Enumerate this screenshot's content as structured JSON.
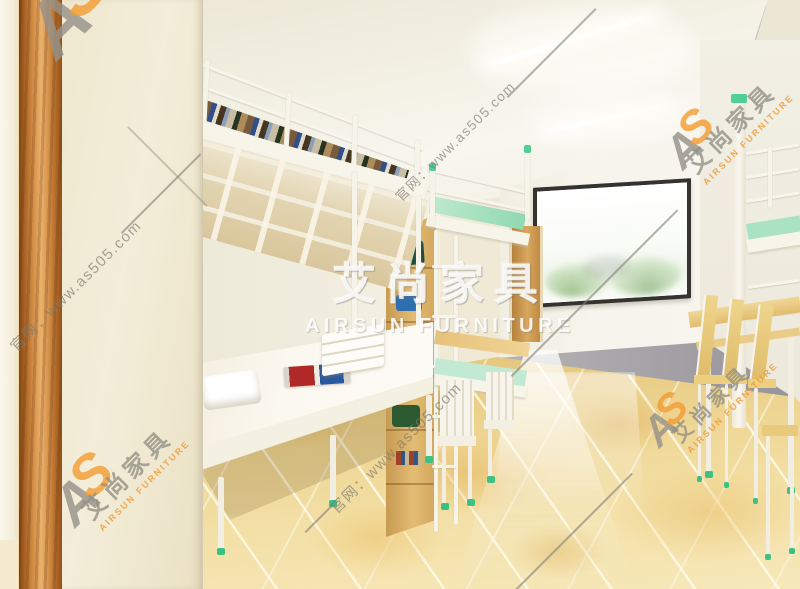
{
  "meta": {
    "description": "3D interior render of a student dormitory with white metal bunk beds, wooden shelving, desks with wooden chairs, a large window and golden marble tile floor",
    "width_px": 800,
    "height_px": 589
  },
  "watermark": {
    "center": {
      "cn": "艾尚家具",
      "en": "AIRSUN FURNITURE"
    },
    "brand": {
      "cn": "艾尚家具",
      "en": "AIRSUN FURNITURE"
    },
    "site": "官网：www.as505.com",
    "logo": {
      "a": "A",
      "s": "S"
    },
    "colors": {
      "center_white": "#ffffff",
      "gray": "#8d8a80",
      "orange": "#f29c3e"
    }
  },
  "scene": {
    "colors": {
      "wall_cream": "#f0e9d2",
      "wood_frame": "#c98a42",
      "floor_gold": "#eed398",
      "bed_white": "#f6f3ea",
      "mint_accent": "#4fd096",
      "bedding_mint": "#bfe9cf",
      "window_frame": "#34332f",
      "desk_wood": "#e8c87e",
      "step_gray": "#9a989a"
    }
  }
}
